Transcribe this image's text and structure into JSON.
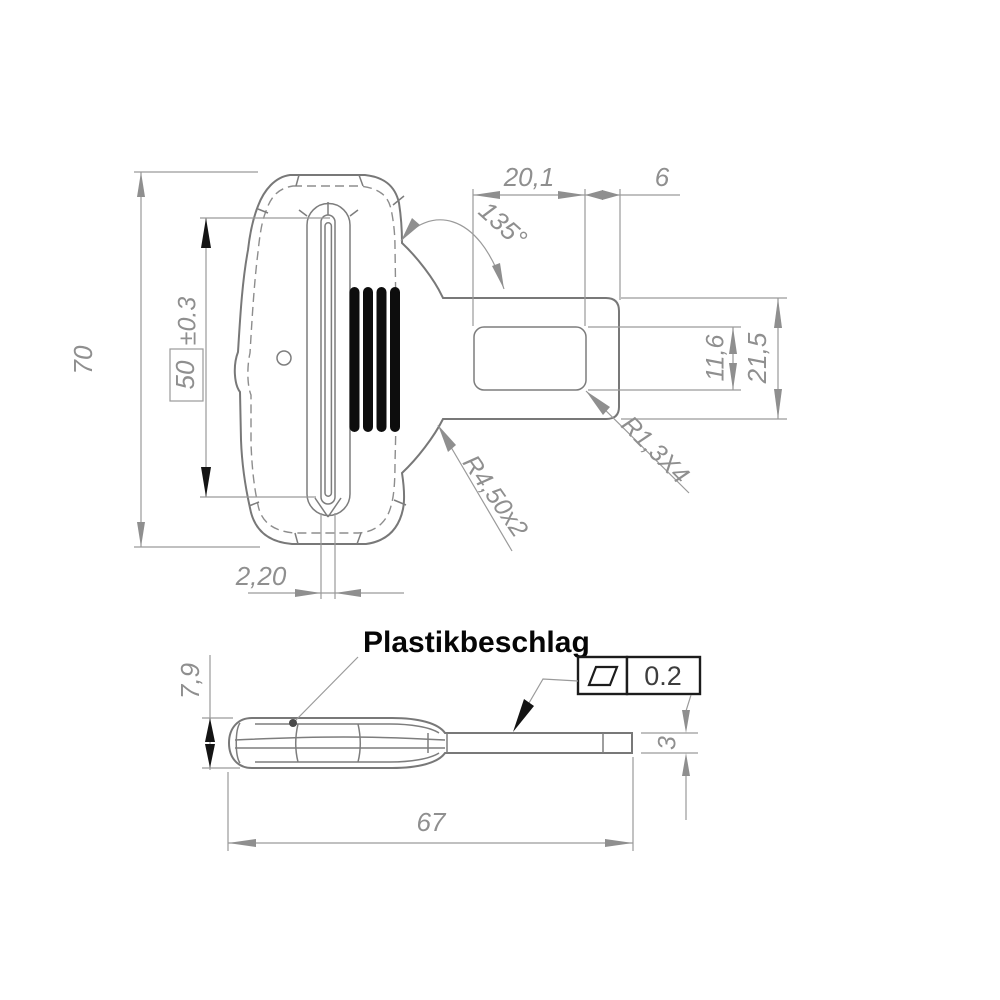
{
  "drawing": {
    "part_label": "Plastikbeschlag",
    "front": {
      "height": "70",
      "slot_height": "50",
      "slot_tol": "±0.3",
      "slot_width": "2,20",
      "cutout_width": "20,1",
      "tip_len": "6",
      "angle": "135°",
      "cutout_height": "11,6",
      "strap_width": "21,5",
      "corner_radius": "R1,3X4",
      "fillet_radius": "R4,50x2"
    },
    "side": {
      "thickness": "7,9",
      "strap_thickness": "3",
      "length": "67",
      "flatness": "0.2"
    },
    "icons": {
      "flatness_symbol": "parallelogram"
    },
    "colors": {
      "outline_gray": "#787878",
      "dimension_gray": "#9a9a9a",
      "text_gray": "#8f8f8f",
      "accent_black": "#111111",
      "background": "#ffffff"
    }
  }
}
